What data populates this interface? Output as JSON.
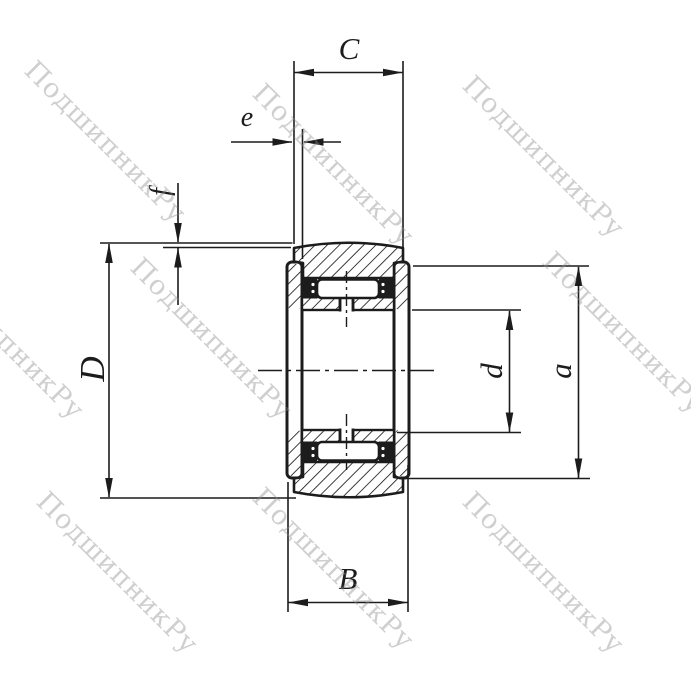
{
  "title": "Bearing cross-section technical drawing",
  "watermark": {
    "text": "ПодшипникРу",
    "color_hex": "#c9c9c9"
  },
  "colors": {
    "line": "#1c1c1c",
    "background": "#ffffff",
    "hatch": "#1c1c1c",
    "seal_fill": "#1c1c1c"
  },
  "dimensions": {
    "C": {
      "label": "C"
    },
    "e": {
      "label": "e"
    },
    "f": {
      "label": "f"
    },
    "D": {
      "label": "D"
    },
    "d": {
      "label": "d"
    },
    "a": {
      "label": "a"
    },
    "B": {
      "label": "B"
    }
  },
  "parts": [
    "outer-ring",
    "inner-ring",
    "side-washers",
    "rollers",
    "seal-blocks",
    "lubrication-hole",
    "centerlines"
  ]
}
